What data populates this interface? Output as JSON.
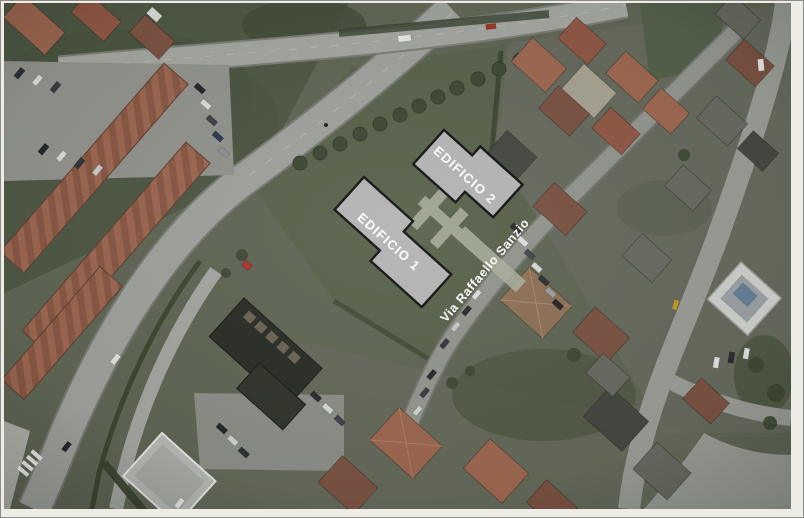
{
  "image": {
    "kind": "aerial-satellite-photo",
    "street": {
      "name": "Via Raffaello Sanzio",
      "label_color": "#ffffff"
    },
    "buildings": [
      {
        "name": "EDIFICIO 1",
        "fill": "#b4b4b4",
        "outline": "#141414",
        "label_color": "#ffffff"
      },
      {
        "name": "EDIFICIO 2",
        "fill": "#b4b4b4",
        "outline": "#141414",
        "label_color": "#ffffff"
      }
    ],
    "frame": {
      "mat_color": "#edece5",
      "border_color": "#8b8b89"
    }
  }
}
